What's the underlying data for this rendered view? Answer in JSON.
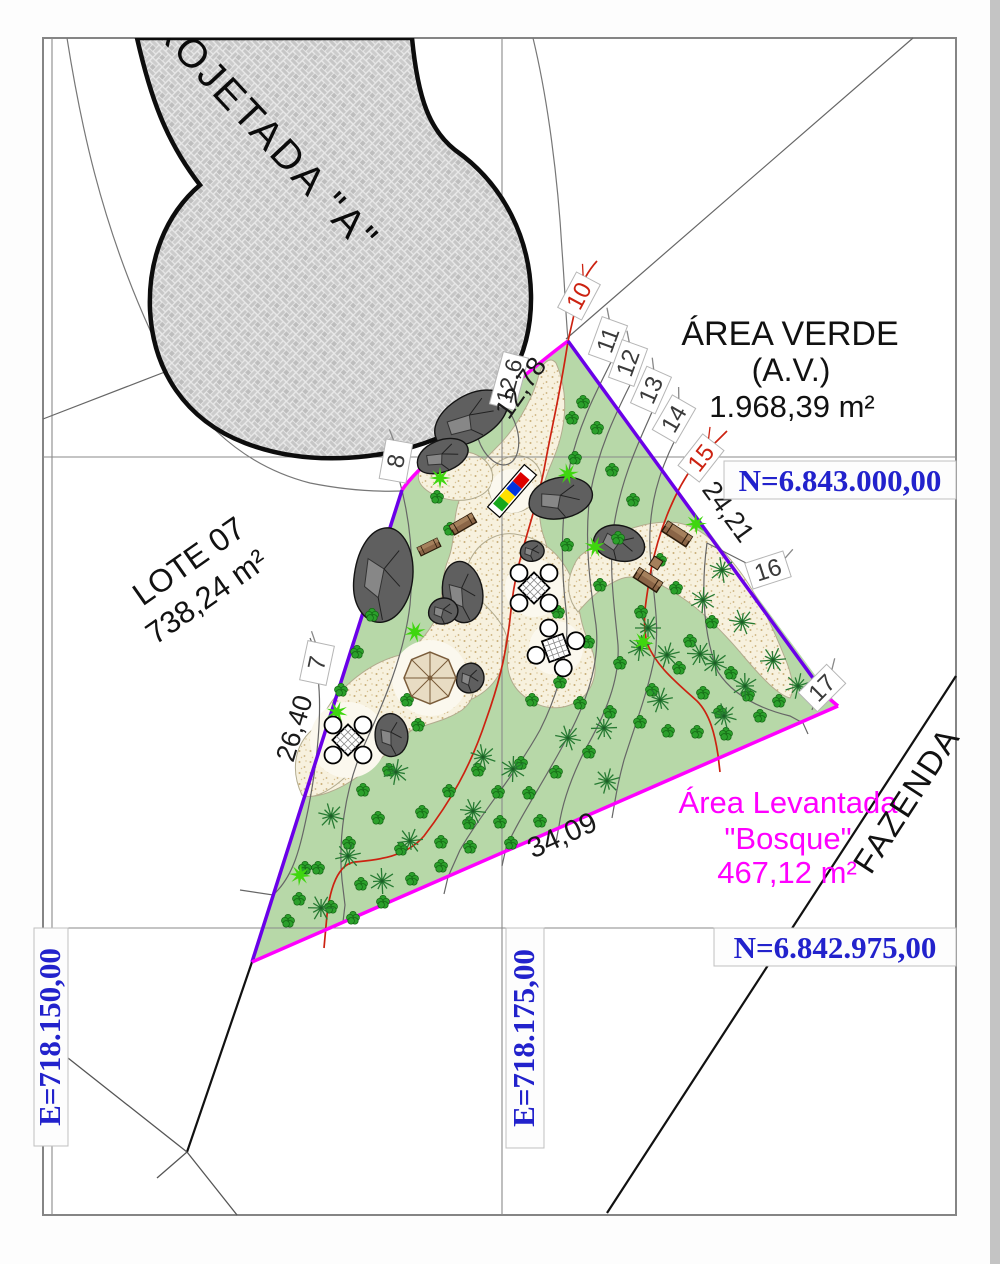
{
  "drawing": {
    "street_label": "ROJETADA \"A\"",
    "area_verde": {
      "title": "ÁREA VERDE",
      "subtitle": "(A.V.)",
      "area": "1.968,39 m²"
    },
    "lote": {
      "title": "LOTE 07",
      "area": "738,24 m²"
    },
    "bosque": {
      "line1": "Área Levantada",
      "line2": "\"Bosque\"",
      "area": "467,12 m²"
    },
    "fazenda_label": "FAZENDA",
    "grid": {
      "n_top": "N=6.843.000,00",
      "n_bottom": "N=6.842.975,00",
      "e_mid": "E=718.175,00",
      "e_left": "E=718.150,00"
    },
    "dimensions": {
      "nw_edge": "12,78",
      "nw_spot": "12,6",
      "ne_edge": "24,21",
      "w_edge": "26,40",
      "s_edge": "34,09"
    },
    "contour_labels": [
      "7",
      "8",
      "10",
      "11",
      "12",
      "13",
      "14",
      "15",
      "16",
      "17"
    ],
    "colors": {
      "boundary_magenta": "#ff00ff",
      "boundary_purple": "#6a00e8",
      "contour_major": "#cc2211",
      "contour_minor": "#666666",
      "coordinate_blue": "#2222cc",
      "grass_green": "#b7d8a8"
    }
  }
}
